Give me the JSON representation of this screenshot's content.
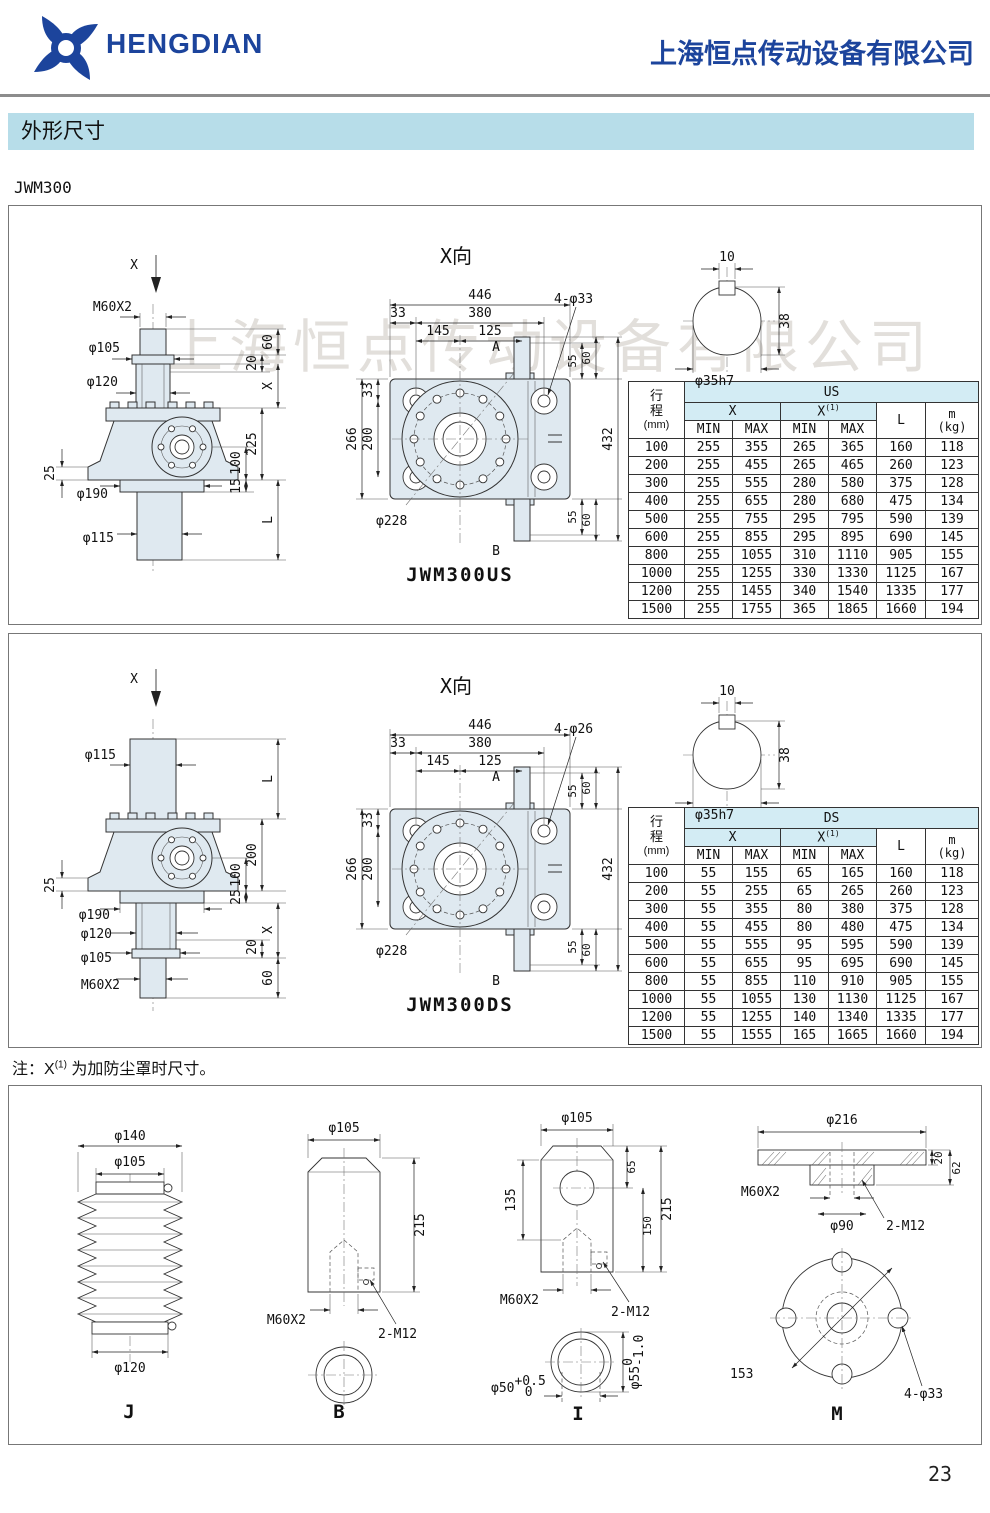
{
  "page": {
    "brand": "HENGDIAN",
    "company": "上海恒点传动设备有限公司",
    "section_title": "外形尺寸",
    "model": "JWM300",
    "note_prefix": "注：X",
    "note_sup": "(1)",
    "note_suffix": "为加防尘罩时尺寸。",
    "page_number": "23",
    "watermark": "上海恒点传动设备有限公司"
  },
  "colors": {
    "brand_blue": "#1c449c",
    "banner_bg": "#b7dde9",
    "table_head_bg": "#d3ecf4",
    "drawing_fill": "#dfe9f0",
    "watermark_color": "rgba(190,185,175,0.45)"
  },
  "shaft_section": {
    "dim10": "10",
    "dim38": "38",
    "dia": "φ35h7"
  },
  "us": {
    "view_label": "X向",
    "caption": "JWM300US",
    "side": {
      "x": "X",
      "thread": "M60X2",
      "d105": "φ105",
      "d120": "φ120",
      "dim60": "60",
      "dim20": "20",
      "dimx": "X",
      "dim225": "225",
      "dim100": "100",
      "dim25": "25",
      "d190": "φ190",
      "dim15": "15",
      "d115": "φ115",
      "diml": "L"
    },
    "top": {
      "dim446": "446",
      "dim380": "380",
      "dim145": "145",
      "dim125": "125",
      "dim33t": "33",
      "holes": "4-φ33",
      "pta": "A",
      "ptb": "B",
      "dim55t": "55",
      "dim60t": "60",
      "dim55b": "55",
      "dim60b": "60",
      "dim432": "432",
      "dim33l": "33",
      "dim200": "200",
      "dim266": "266",
      "d228": "φ228"
    }
  },
  "ds": {
    "view_label": "X向",
    "caption": "JWM300DS",
    "side": {
      "x": "X",
      "d115": "φ115",
      "diml": "L",
      "dim200": "200",
      "dim100": "100",
      "dim25l": "25",
      "dim25r": "25",
      "dimx": "X",
      "dim20": "20",
      "dim60": "60",
      "d190": "φ190",
      "d120": "φ120",
      "d105": "φ105",
      "thread": "M60X2"
    },
    "top": {
      "dim446": "446",
      "dim380": "380",
      "dim145": "145",
      "dim125": "125",
      "dim33t": "33",
      "holes": "4-φ26",
      "pta": "A",
      "ptb": "B",
      "dim55t": "55",
      "dim60t": "60",
      "dim55b": "55",
      "dim60b": "60",
      "dim432": "432",
      "dim33l": "33",
      "dim200": "200",
      "dim266": "266",
      "d228": "φ228"
    }
  },
  "table_us": {
    "rowhead_1": "行",
    "rowhead_2": "程",
    "rowhead_unit": "(mm)",
    "group": "US",
    "x": "X",
    "x1": "X",
    "x1_sup": "(1)",
    "min": "MIN",
    "max": "MAX",
    "l": "L",
    "m": "m",
    "m_unit": "(kg)",
    "rows": [
      [
        "100",
        "255",
        "355",
        "265",
        "365",
        "160",
        "118"
      ],
      [
        "200",
        "255",
        "455",
        "265",
        "465",
        "260",
        "123"
      ],
      [
        "300",
        "255",
        "555",
        "280",
        "580",
        "375",
        "128"
      ],
      [
        "400",
        "255",
        "655",
        "280",
        "680",
        "475",
        "134"
      ],
      [
        "500",
        "255",
        "755",
        "295",
        "795",
        "590",
        "139"
      ],
      [
        "600",
        "255",
        "855",
        "295",
        "895",
        "690",
        "145"
      ],
      [
        "800",
        "255",
        "1055",
        "310",
        "1110",
        "905",
        "155"
      ],
      [
        "1000",
        "255",
        "1255",
        "330",
        "1330",
        "1125",
        "167"
      ],
      [
        "1200",
        "255",
        "1455",
        "340",
        "1540",
        "1335",
        "177"
      ],
      [
        "1500",
        "255",
        "1755",
        "365",
        "1865",
        "1660",
        "194"
      ]
    ]
  },
  "table_ds": {
    "rowhead_1": "行",
    "rowhead_2": "程",
    "rowhead_unit": "(mm)",
    "group": "DS",
    "x": "X",
    "x1": "X",
    "x1_sup": "(1)",
    "min": "MIN",
    "max": "MAX",
    "l": "L",
    "m": "m",
    "m_unit": "(kg)",
    "rows": [
      [
        "100",
        "55",
        "155",
        "65",
        "165",
        "160",
        "118"
      ],
      [
        "200",
        "55",
        "255",
        "65",
        "265",
        "260",
        "123"
      ],
      [
        "300",
        "55",
        "355",
        "80",
        "380",
        "375",
        "128"
      ],
      [
        "400",
        "55",
        "455",
        "80",
        "480",
        "475",
        "134"
      ],
      [
        "500",
        "55",
        "555",
        "95",
        "595",
        "590",
        "139"
      ],
      [
        "600",
        "55",
        "655",
        "95",
        "695",
        "690",
        "145"
      ],
      [
        "800",
        "55",
        "855",
        "110",
        "910",
        "905",
        "155"
      ],
      [
        "1000",
        "55",
        "1055",
        "130",
        "1130",
        "1125",
        "167"
      ],
      [
        "1200",
        "55",
        "1255",
        "140",
        "1340",
        "1335",
        "177"
      ],
      [
        "1500",
        "55",
        "1555",
        "165",
        "1665",
        "1660",
        "194"
      ]
    ]
  },
  "acc_j": {
    "caption": "J",
    "d140": "φ140",
    "d105": "φ105",
    "d120": "φ120"
  },
  "acc_b": {
    "caption": "B",
    "d105": "φ105",
    "dim215": "215",
    "thread": "M60X2",
    "holes": "2-M12"
  },
  "acc_i": {
    "caption": "I",
    "d105": "φ105",
    "dim135": "135",
    "dim65": "65",
    "dim150": "150",
    "dim215": "215",
    "thread": "M60X2",
    "holes": "2-M12",
    "d50": "φ50",
    "d50_sup": "+0.5",
    "d50_sub": "0",
    "d55": "φ55",
    "d55_sup": "0",
    "d55_sub": "-1.0"
  },
  "acc_m": {
    "caption": "M",
    "d216": "φ216",
    "dim20": "20",
    "dim62": "62",
    "thread": "M60X2",
    "d90": "φ90",
    "holes2": "2-M12",
    "dim153": "153",
    "holes4": "4-φ33"
  }
}
